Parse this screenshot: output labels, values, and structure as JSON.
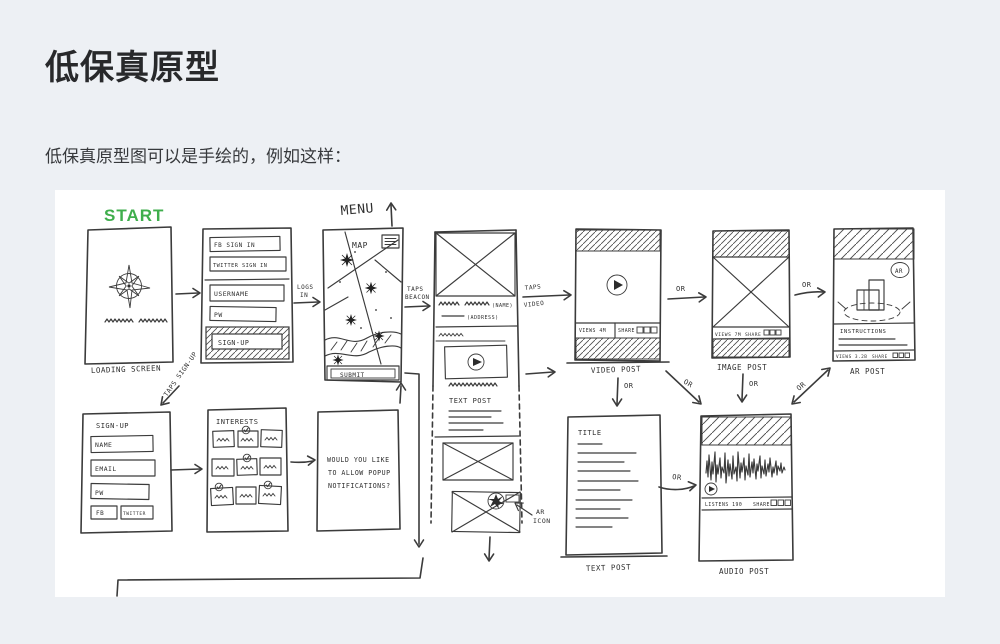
{
  "page": {
    "title": "低保真原型",
    "intro": "低保真原型图可以是手绘的，例如这样："
  },
  "colors": {
    "background": "#edf0f4",
    "panel": "#ffffff",
    "ink": "#3b3b3b",
    "start_green": "#3fae4c"
  },
  "sketch": {
    "start": "START",
    "menu": "MENU",
    "or": "OR",
    "loading": {
      "caption": "LOADING SCREEN"
    },
    "signin": {
      "fb": "FB SIGN IN",
      "twitter": "TWITTER SIGN IN",
      "username": "USERNAME",
      "pw": "PW",
      "signup": "SIGN-UP"
    },
    "logs_in_1": "LOGS",
    "logs_in_2": "IN",
    "taps_signup": "TAPS SIGN-UP",
    "map": {
      "title": "MAP",
      "submit": "SUBMIT"
    },
    "taps_beacon_1": "TAPS",
    "taps_beacon_2": "BEACON",
    "taps_video_1": "TAPS",
    "taps_video_2": "VIDEO",
    "feed": {
      "name": "(NAME)",
      "address": "(ADDRESS)",
      "text_post": "TEXT POST",
      "ar_icon_1": "AR",
      "ar_icon_2": "ICON"
    },
    "video_post": {
      "caption": "VIDEO POST",
      "views": "VIEWS 4M",
      "share": "SHARE"
    },
    "image_post": {
      "caption": "IMAGE POST",
      "views": "VIEWS 7M",
      "share": "SHARE"
    },
    "ar_post": {
      "caption": "AR POST",
      "badge": "AR",
      "instructions": "INSTRUCTIONS",
      "views": "VIEWS 3.2B",
      "share": "SHARE"
    },
    "signup2": {
      "title": "SIGN-UP",
      "name": "NAME",
      "email": "EMAIL",
      "pw": "PW",
      "fb": "FB",
      "twitter": "TWITTER"
    },
    "interests": {
      "title": "INTERESTS"
    },
    "notifications": {
      "line1": "WOULD YOU LIKE",
      "line2": "TO ALLOW POPUP",
      "line3": "NOTIFICATIONS?"
    },
    "text_post": {
      "title": "TITLE",
      "caption": "TEXT POST"
    },
    "audio_post": {
      "caption": "AUDIO POST",
      "listens": "LISTENS 190",
      "share": "SHARE"
    }
  }
}
